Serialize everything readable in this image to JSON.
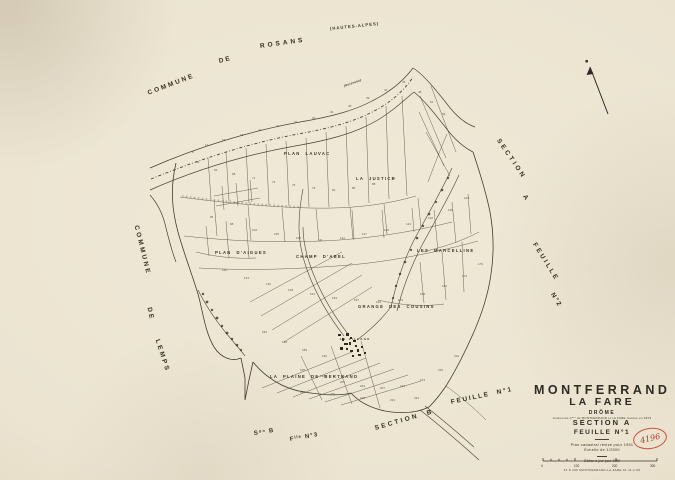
{
  "canvas": {
    "paper_color": "#ece4d1",
    "ink_color": "#43392d",
    "stamp_red": "#b43c2c"
  },
  "labels": {
    "edge": [
      {
        "t": "COMMUNE",
        "x": 148,
        "y": 90,
        "r": -21,
        "s": 6.5,
        "ls": 2.2,
        "n": "edge-label-commune-de-rosans"
      },
      {
        "t": "DE",
        "x": 219,
        "y": 58,
        "r": -15,
        "s": 6.5,
        "ls": 2,
        "n": "edge-label-commune-de-rosans"
      },
      {
        "t": "ROSANS",
        "x": 260,
        "y": 43,
        "r": -8,
        "s": 6.5,
        "ls": 3,
        "n": "edge-label-commune-de-rosans"
      },
      {
        "t": "(HAUTES-ALPES)",
        "x": 330,
        "y": 26,
        "r": -6,
        "s": 4.2,
        "ls": 1,
        "n": "edge-label-hautes-alpes"
      },
      {
        "t": "COMMUNE",
        "x": 136,
        "y": 222,
        "r": 76,
        "s": 6.5,
        "ls": 2.4,
        "n": "edge-label-commune-de-lemps"
      },
      {
        "t": "DE",
        "x": 149,
        "y": 304,
        "r": 78,
        "s": 6.5,
        "ls": 2,
        "n": "edge-label-commune-de-lemps"
      },
      {
        "t": "LEMPS",
        "x": 157,
        "y": 336,
        "r": 72,
        "s": 6.5,
        "ls": 2.4,
        "n": "edge-label-commune-de-lemps"
      },
      {
        "t": "SECTION",
        "x": 498,
        "y": 136,
        "r": 56,
        "s": 6.5,
        "ls": 2.6,
        "n": "edge-label-section-a"
      },
      {
        "t": "A",
        "x": 524,
        "y": 192,
        "r": 56,
        "s": 6.5,
        "ls": 2,
        "n": "edge-label-section-a"
      },
      {
        "t": "FEUILLE",
        "x": 534,
        "y": 240,
        "r": 58,
        "s": 6.5,
        "ls": 2.4,
        "n": "edge-label-feuille-2"
      },
      {
        "t": "N°2",
        "x": 552,
        "y": 290,
        "r": 58,
        "s": 6.5,
        "ls": 1.5,
        "n": "edge-label-feuille-2"
      },
      {
        "t": "Sᵒⁿ B",
        "x": 254,
        "y": 431,
        "r": -9,
        "s": 6,
        "ls": 1.2,
        "n": "edge-label-section-b-abbrev"
      },
      {
        "t": "Fˡˡᵉ N°3",
        "x": 290,
        "y": 437,
        "r": -10,
        "s": 6,
        "ls": 1.2,
        "n": "edge-label-feuille-3-abbrev"
      },
      {
        "t": "SECTION  B",
        "x": 375,
        "y": 425,
        "r": -16,
        "s": 6.5,
        "ls": 2.4,
        "n": "edge-label-section-b"
      },
      {
        "t": "FEUILLE  N°1",
        "x": 451,
        "y": 399,
        "r": -12,
        "s": 6.5,
        "ls": 1.8,
        "n": "edge-label-feuille-1"
      }
    ],
    "place": [
      {
        "t": "PLAN  LAUVAC",
        "x": 284,
        "y": 151,
        "n": "place-label-plan-lauvac"
      },
      {
        "t": "LA  JUSTICE",
        "x": 356,
        "y": 176,
        "n": "place-label-la-justice"
      },
      {
        "t": "PLAN  D'AIGUES",
        "x": 215,
        "y": 250,
        "n": "place-label-plan-daigues"
      },
      {
        "t": "CHAMP  D'ABEL",
        "x": 296,
        "y": 254,
        "n": "place-label-champ-dabel"
      },
      {
        "t": "LES  MARCELLINE",
        "x": 417,
        "y": 248,
        "n": "place-label-les-marcelline"
      },
      {
        "t": "GRANGE  DES  COUSINS",
        "x": 358,
        "y": 304,
        "n": "place-label-grange-des-cousins"
      },
      {
        "t": "LE VILLAGE",
        "x": 340,
        "y": 337,
        "s": 3,
        "n": "place-label-le-village"
      },
      {
        "t": "LA  PLAINE  DE  BERTRAND",
        "x": 270,
        "y": 374,
        "n": "place-label-la-plaine-de-bertrand"
      },
      {
        "t": "(Ruisseau)",
        "x": 344,
        "y": 84,
        "r": -20,
        "s": 3,
        "i": 1,
        "ls": 0.3,
        "n": "place-label-ruisseau"
      }
    ],
    "numbers": [
      {
        "t": "8",
        "x": 192,
        "y": 150
      },
      {
        "t": "12",
        "x": 205,
        "y": 143
      },
      {
        "t": "15",
        "x": 222,
        "y": 138
      },
      {
        "t": "18",
        "x": 240,
        "y": 133
      },
      {
        "t": "21",
        "x": 258,
        "y": 128
      },
      {
        "t": "24",
        "x": 276,
        "y": 124
      },
      {
        "t": "27",
        "x": 294,
        "y": 120
      },
      {
        "t": "30",
        "x": 312,
        "y": 116
      },
      {
        "t": "33",
        "x": 330,
        "y": 110
      },
      {
        "t": "36",
        "x": 348,
        "y": 104
      },
      {
        "t": "39",
        "x": 366,
        "y": 96
      },
      {
        "t": "42",
        "x": 384,
        "y": 88
      },
      {
        "t": "45",
        "x": 402,
        "y": 80
      },
      {
        "t": "48",
        "x": 418,
        "y": 90
      },
      {
        "t": "51",
        "x": 430,
        "y": 100
      },
      {
        "t": "54",
        "x": 442,
        "y": 112
      },
      {
        "t": "62",
        "x": 196,
        "y": 160
      },
      {
        "t": "65",
        "x": 214,
        "y": 168
      },
      {
        "t": "68",
        "x": 232,
        "y": 172
      },
      {
        "t": "71",
        "x": 252,
        "y": 176
      },
      {
        "t": "74",
        "x": 272,
        "y": 180
      },
      {
        "t": "76",
        "x": 292,
        "y": 183
      },
      {
        "t": "79",
        "x": 312,
        "y": 186
      },
      {
        "t": "82",
        "x": 332,
        "y": 188
      },
      {
        "t": "85",
        "x": 352,
        "y": 186
      },
      {
        "t": "88",
        "x": 372,
        "y": 182
      },
      {
        "t": "91",
        "x": 392,
        "y": 176
      },
      {
        "t": "95",
        "x": 210,
        "y": 215
      },
      {
        "t": "98",
        "x": 230,
        "y": 222
      },
      {
        "t": "102",
        "x": 252,
        "y": 228
      },
      {
        "t": "105",
        "x": 274,
        "y": 232
      },
      {
        "t": "108",
        "x": 296,
        "y": 236
      },
      {
        "t": "111",
        "x": 318,
        "y": 238
      },
      {
        "t": "114",
        "x": 340,
        "y": 236
      },
      {
        "t": "117",
        "x": 362,
        "y": 232
      },
      {
        "t": "120",
        "x": 384,
        "y": 228
      },
      {
        "t": "123",
        "x": 406,
        "y": 222
      },
      {
        "t": "126",
        "x": 428,
        "y": 216
      },
      {
        "t": "129",
        "x": 448,
        "y": 208
      },
      {
        "t": "132",
        "x": 464,
        "y": 196
      },
      {
        "t": "140",
        "x": 222,
        "y": 268
      },
      {
        "t": "143",
        "x": 244,
        "y": 276
      },
      {
        "t": "146",
        "x": 266,
        "y": 282
      },
      {
        "t": "148",
        "x": 288,
        "y": 288
      },
      {
        "t": "151",
        "x": 310,
        "y": 292
      },
      {
        "t": "154",
        "x": 332,
        "y": 296
      },
      {
        "t": "157",
        "x": 354,
        "y": 298
      },
      {
        "t": "160",
        "x": 376,
        "y": 300
      },
      {
        "t": "163",
        "x": 398,
        "y": 298
      },
      {
        "t": "166",
        "x": 420,
        "y": 292
      },
      {
        "t": "169",
        "x": 442,
        "y": 284
      },
      {
        "t": "172",
        "x": 462,
        "y": 274
      },
      {
        "t": "175",
        "x": 478,
        "y": 262
      },
      {
        "t": "183",
        "x": 262,
        "y": 330
      },
      {
        "t": "186",
        "x": 282,
        "y": 340
      },
      {
        "t": "189",
        "x": 302,
        "y": 348
      },
      {
        "t": "192",
        "x": 322,
        "y": 354
      },
      {
        "t": "195",
        "x": 300,
        "y": 368
      },
      {
        "t": "198",
        "x": 320,
        "y": 374
      },
      {
        "t": "201",
        "x": 340,
        "y": 380
      },
      {
        "t": "204",
        "x": 360,
        "y": 384
      },
      {
        "t": "207",
        "x": 380,
        "y": 386
      },
      {
        "t": "210",
        "x": 400,
        "y": 384
      },
      {
        "t": "213",
        "x": 420,
        "y": 378
      },
      {
        "t": "216",
        "x": 438,
        "y": 368
      },
      {
        "t": "219",
        "x": 454,
        "y": 354
      },
      {
        "t": "222",
        "x": 300,
        "y": 390
      },
      {
        "t": "225",
        "x": 330,
        "y": 392
      },
      {
        "t": "228",
        "x": 360,
        "y": 396
      },
      {
        "t": "231",
        "x": 390,
        "y": 398
      },
      {
        "t": "234",
        "x": 414,
        "y": 396
      }
    ],
    "scale": [
      {
        "t": "0",
        "x": 541,
        "y": 464
      },
      {
        "t": "100",
        "x": 574,
        "y": 464
      },
      {
        "t": "200",
        "x": 612,
        "y": 464
      },
      {
        "t": "300",
        "x": 650,
        "y": 464
      }
    ]
  },
  "title_block": {
    "name1": "MONTFERRAND",
    "name2": "LA FARE",
    "dept": "DRÔME",
    "note": "Anciennes Cⁿᵉˢ de MONTFERRAND et LA FARE réunies en 1873",
    "section": "SECTION  A",
    "sheet": "FEUILLE   N°1",
    "revision": "Plan cadastral révisé pour 1951",
    "scale_text": "Échelle de 1/2500",
    "edition": "Édition à jour pour 1959",
    "reference": "44 S 196   MONTFERRAND-LA-FARE   A1   11-1-59"
  },
  "stamp": {
    "text": "4196"
  }
}
